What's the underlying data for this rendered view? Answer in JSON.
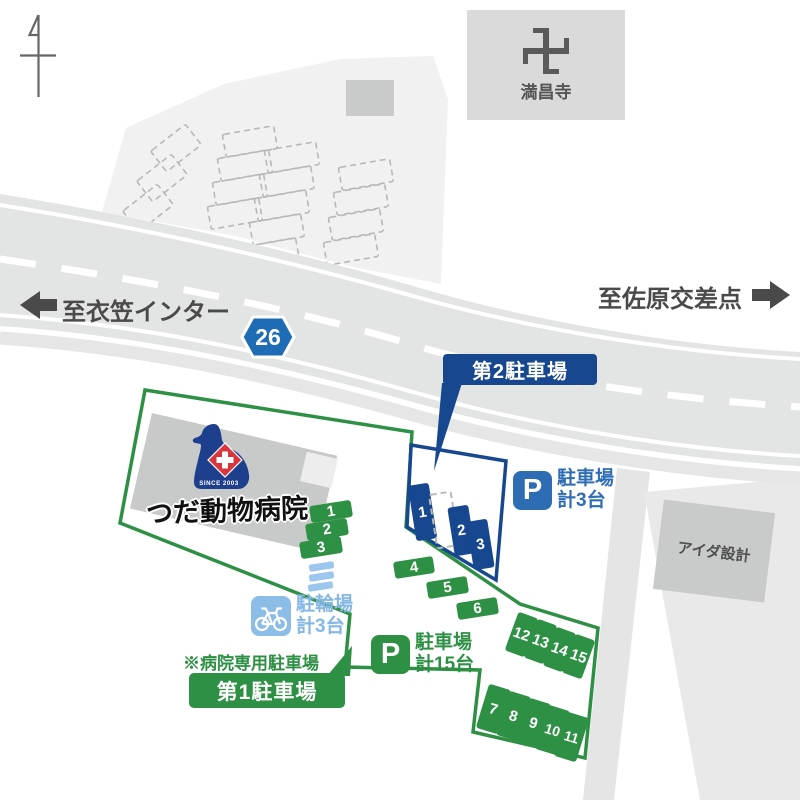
{
  "landmarks": {
    "temple": {
      "name": "満昌寺"
    },
    "aida_sekkei": {
      "name": "アイダ設計"
    }
  },
  "road": {
    "route_number": "26",
    "to_left": "至衣笠インター",
    "to_right": "至佐原交差点"
  },
  "hospital": {
    "name": "つだ動物病院",
    "logo_text": "SINCE 2003"
  },
  "lot2": {
    "title": "第2駐車場",
    "p": "P",
    "capacity1": "駐車場",
    "capacity2": "計3台",
    "spaces": [
      "1",
      "2",
      "3"
    ]
  },
  "lot1": {
    "title": "第1駐車場",
    "note": "※病院専用駐車場",
    "p": "P",
    "capacity1": "駐車場",
    "capacity2": "計15台",
    "row_hospital": [
      "1",
      "2",
      "3"
    ],
    "row_mid": [
      "4",
      "5",
      "6"
    ],
    "row_upper_right": [
      "12",
      "13",
      "14",
      "15"
    ],
    "row_lower_right": [
      "7",
      "8",
      "9",
      "10",
      "11"
    ]
  },
  "bicycle_parking": {
    "label1": "駐輪場",
    "label2": "計3台"
  },
  "colors": {
    "green": "#2e9044",
    "dark_blue": "#17478e",
    "mid_blue": "#2e6db4",
    "light_blue": "#8cbde7",
    "road_gray": "#e3e4e4",
    "building_gray": "#c8caca",
    "logo_navy": "#1e3e8e",
    "logo_red": "#d8353d"
  }
}
